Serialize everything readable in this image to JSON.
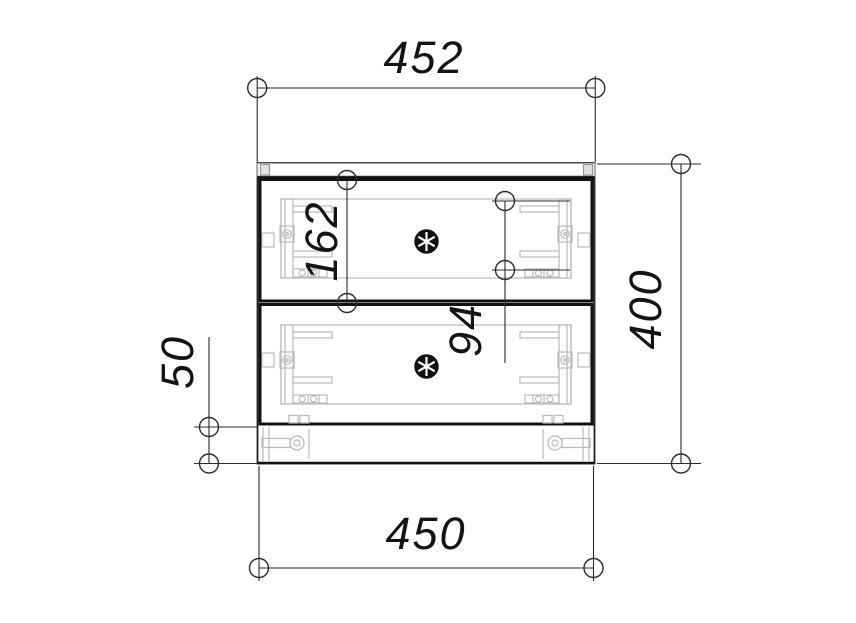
{
  "drawing": {
    "type": "technical-drawing",
    "view": "cabinet-front-elevation",
    "dimensions": {
      "top": "452",
      "right": "400",
      "bottom": "450",
      "left": "50",
      "inner_drawer": "162",
      "inner_slide": "94"
    },
    "colors": {
      "line": "#141414",
      "hardware": "#b9b9b9",
      "background": "#ffffff"
    }
  }
}
